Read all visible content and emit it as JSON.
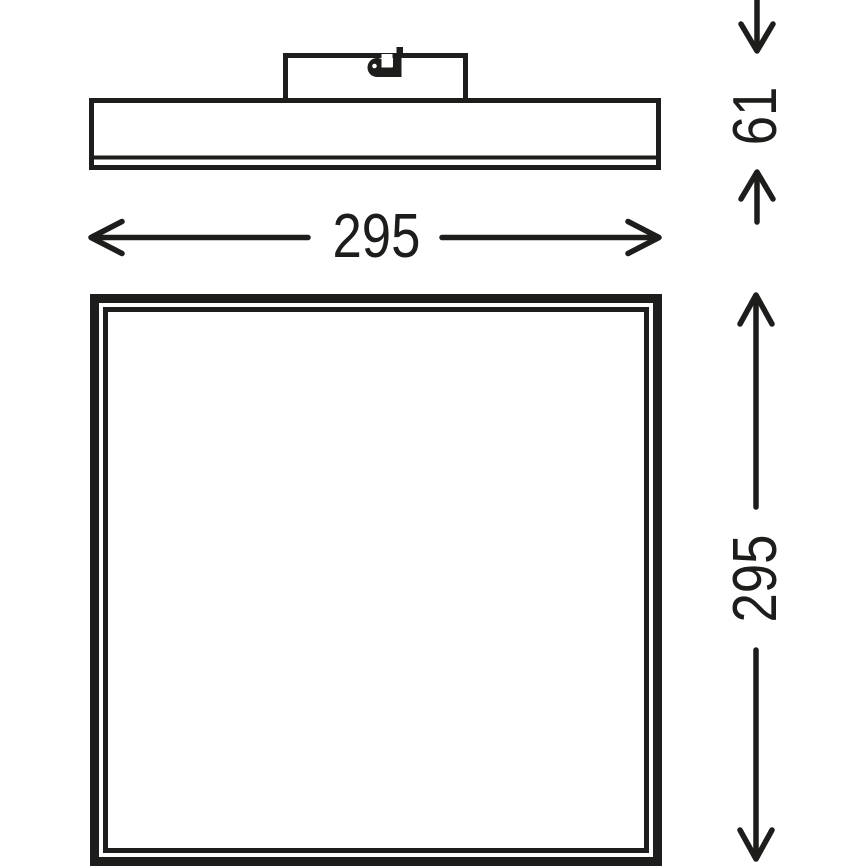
{
  "page": {
    "background_color": "#ffffff",
    "ink_color": "#1d1d1b"
  },
  "drawing": {
    "kind": "product dimension drawing",
    "icons": [
      {
        "name": "cable-clamp-icon",
        "location": "inside mounting canopy of side view"
      }
    ]
  },
  "labels": {
    "panel_width": "295",
    "panel_height": "295",
    "fixture_depth": "61"
  }
}
